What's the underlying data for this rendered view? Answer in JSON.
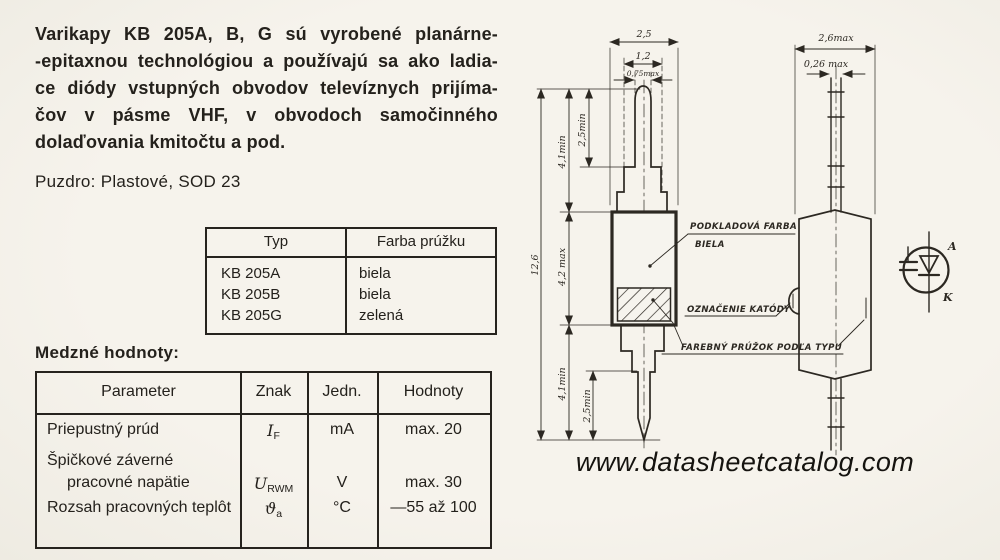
{
  "intro": {
    "lines": [
      "Varikapy KB 205A, B, G sú vyrobené planárne-",
      "-epitaxnou technológiou a používajú sa ako ladia-",
      "ce diódy vstupných obvodov televíznych prijíma-",
      "čov v pásme VHF, v obvodoch samočinného",
      "dolaďovania kmitočtu a pod."
    ]
  },
  "package_line": "Puzdro: Plastové, SOD 23",
  "type_table": {
    "headers": [
      "Typ",
      "Farba prúžku"
    ],
    "rows": [
      {
        "typ": "KB 205A",
        "farba": "biela"
      },
      {
        "typ": "KB 205B",
        "farba": "biela"
      },
      {
        "typ": "KB 205G",
        "farba": "zelená"
      }
    ]
  },
  "limits": {
    "heading": "Medzné hodnoty:",
    "headers": [
      "Parameter",
      "Znak",
      "Jedn.",
      "Hodnoty"
    ],
    "rows": [
      {
        "parameter": "Priepustný prúd",
        "symbol_base": "I",
        "symbol_sub": "F",
        "unit": "mA",
        "value": "max. 20"
      },
      {
        "parameter": "Špičkové záverné",
        "symbol_base": "",
        "symbol_sub": "",
        "unit": "",
        "value": ""
      },
      {
        "parameter": "pracovné napätie",
        "symbol_base": "U",
        "symbol_sub": "RWM",
        "unit": "V",
        "value": "max. 30"
      },
      {
        "parameter": "Rozsah pracovných teplôt",
        "symbol_base": "ϑ",
        "symbol_sub": "a",
        "unit": "°C",
        "value": "—55 až 100"
      }
    ]
  },
  "drawing": {
    "front_view": {
      "dim_body_width": "2,5",
      "dim_step_width": "1,2",
      "dim_blade_width": "0,75max",
      "dim_total_height": "12,6",
      "dim_lead_top": "4,1min",
      "dim_blade_top": "2,5min",
      "dim_body_height": "4,2 max",
      "dim_lead_bottom": "4,1min",
      "dim_blade_bottom": "2,5min"
    },
    "side_view": {
      "dim_width": "2,6max",
      "dim_lead_thickness": "0,26 max"
    },
    "annotations": {
      "base_color_line1": "PODKLADOVÁ FARBA",
      "base_color_line2": "BIELA",
      "cathode_mark": "OZNAČENIE KATÓDY",
      "color_stripe": "FAREBNÝ PRÚŽOK PODĽA TYPU"
    },
    "symbol": {
      "anode": "A",
      "cathode": "K"
    }
  },
  "watermark": "www.datasheetcatalog.com"
}
